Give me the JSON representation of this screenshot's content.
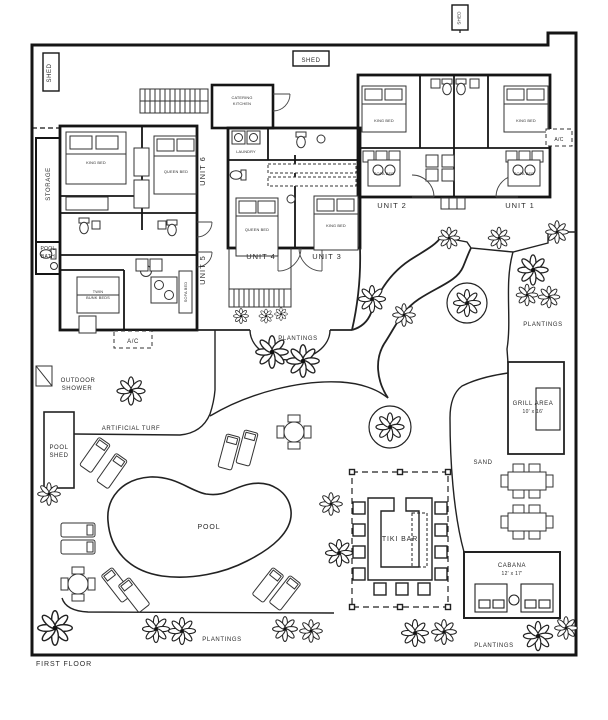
{
  "plan": {
    "title": "FIRST FLOOR",
    "sheds": {
      "left": "SHED",
      "top": "SHED",
      "right": "SHED"
    },
    "units": {
      "u1": "UNIT 1",
      "u2": "UNIT 2",
      "u3": "UNIT 3",
      "u4": "UNIT 4",
      "u5": "UNIT 5",
      "u6": "UNIT 6"
    },
    "rooms": {
      "storage": "STORAGE",
      "pool_bath_line1": "POOL",
      "pool_bath_line2": "BATH",
      "catering_line1": "CATERING",
      "catering_line2": "KITCHEN",
      "laundry": "LAUNDRY",
      "ac": "A/C",
      "king_bed": "KING BED",
      "queen_bed": "QUEEN BED",
      "sofa_bed": "SOFA BED",
      "bunk_line1": "TWIN",
      "bunk_line2": "BUNK BEDS"
    },
    "outdoor": {
      "outdoor_shower_line1": "OUTDOOR",
      "outdoor_shower_line2": "SHOWER",
      "artificial_turf": "ARTIFICIAL TURF",
      "pool_shed_line1": "POOL",
      "pool_shed_line2": "SHED",
      "pool": "POOL",
      "tiki_bar": "TIKI BAR",
      "sand": "SAND",
      "grill_area": "GRILL AREA",
      "grill_dims": "10' x 16'",
      "cabana": "CABANA",
      "cabana_dims": "12' x 17'",
      "plantings": "PLANTINGS"
    },
    "colors": {
      "line": "#1d1d1d",
      "background": "#ffffff"
    }
  }
}
